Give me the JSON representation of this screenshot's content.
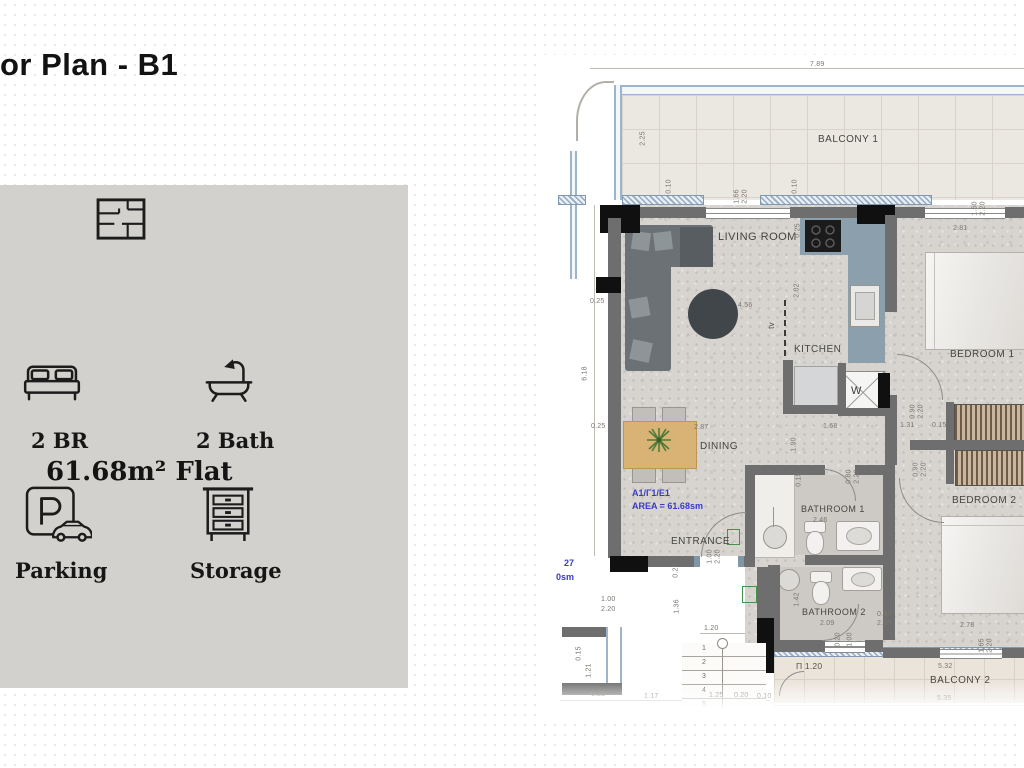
{
  "slide": {
    "title": "or Plan - B1"
  },
  "info_panel": {
    "area_title": "61.68m² Flat",
    "bedrooms_label": "2 BR",
    "bathrooms_label": "2 Bath",
    "parking_label": "Parking",
    "storage_label": "Storage"
  },
  "floor_plan": {
    "unit_code": "A1/Γ1/E1",
    "unit_area": "AREA = 61.68sm",
    "neighbor_partial": {
      "line1": "27",
      "line2": "0sm"
    },
    "rooms": {
      "living_room": "LIVING ROOM",
      "kitchen": "KITCHEN",
      "dining": "DINING",
      "entrance": "ENTRANCE",
      "bedroom1": "BEDROOM 1",
      "bedroom2": "BEDROOM 2",
      "bathroom1": "BATHROOM 1",
      "bathroom2": "BATHROOM 2",
      "balcony1": "BALCONY 1",
      "balcony2": "BALCONY 2"
    },
    "annotations": {
      "tv": "tv",
      "washing_machine": "W",
      "balcony_door": "Π 1.20"
    },
    "stairs_steps": [
      "1",
      "2",
      "3",
      "4",
      "5"
    ],
    "dimensions": [
      "7.89",
      "2.25",
      "0.10",
      "1.66",
      "2.20",
      "0.10",
      "1.50",
      "2.20",
      "2.81",
      "0.25",
      "6.18",
      "0.25",
      "4.56",
      "2.02",
      "2.87",
      "1.68",
      "1.31",
      "0.15",
      "1.90",
      "0.90",
      "2.20",
      "0.80",
      "2.20",
      "0.90",
      "2.20",
      "2.46",
      "0.15",
      "1.00",
      "2.20",
      "0.25",
      "1.36",
      "1.00",
      "2.20",
      "1.20",
      "1.42",
      "2.09",
      "0.60",
      "2.20",
      "2.78",
      "1.65",
      "2.20",
      "5.32",
      "5.35",
      "1.17",
      "1.25",
      "0.20",
      "0.10",
      "0.25",
      "1.21",
      "0.15",
      "0.20",
      "1.00",
      "0.25"
    ]
  },
  "colors": {
    "annotation_blue": "#3a3ac6",
    "kitchen_counter": "#8ba0ac",
    "dining_table_wood": "#d9b275",
    "panel_bg": "#d2d1cd",
    "wall_gray": "#6e6e6e",
    "column_black": "#101010"
  }
}
